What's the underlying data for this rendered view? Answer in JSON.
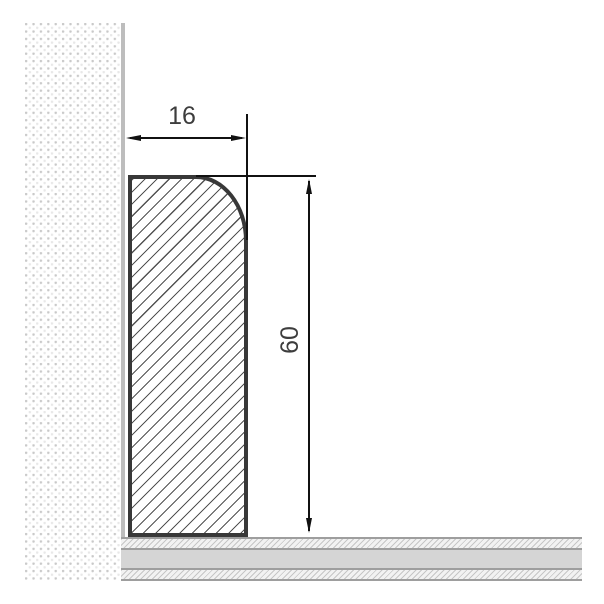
{
  "diagram": {
    "type": "technical-cross-section",
    "subject": "skirting board profile against wall on floor"
  },
  "dimensions": {
    "width": {
      "value": 16,
      "label": "16"
    },
    "height": {
      "value": 60,
      "label": "60"
    }
  },
  "colors": {
    "background": "#ffffff",
    "dimension_line": "#111111",
    "dimension_text": "#3d3d3d",
    "profile_outline": "#383838",
    "profile_hatch": "#525252",
    "wall_dot": "#c9c9c9",
    "wall_face": "#bdbdbd",
    "floor_divider": "#9e9e9e",
    "floor_core": "#d5d5d5",
    "floor_hatch": "#c6c6c6"
  }
}
